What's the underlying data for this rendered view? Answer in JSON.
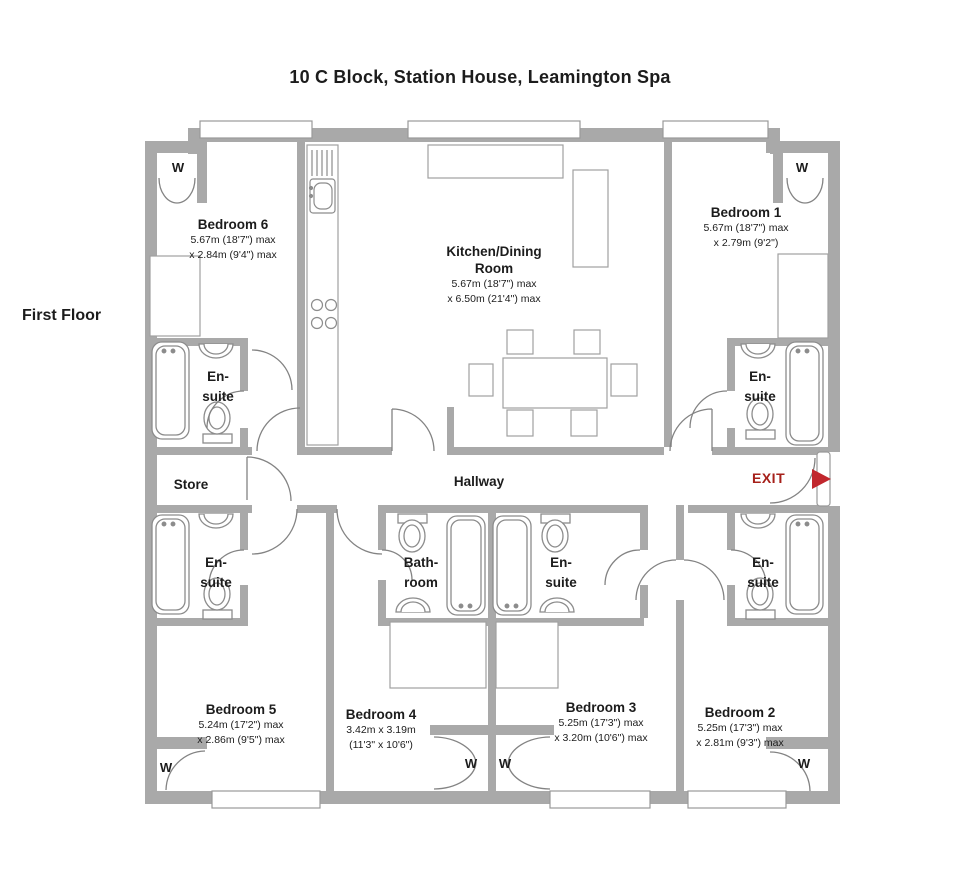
{
  "title": "10 C Block, Station House, Leamington Spa",
  "floor_label": "First Floor",
  "wardrobe_label": "W",
  "exit": {
    "label": "EXIT"
  },
  "colors": {
    "wall": "#a9a9a9",
    "exit_red": "#a6201a",
    "arrow_red": "#c1272d"
  },
  "rooms": {
    "bedroom6": {
      "name": "Bedroom 6",
      "dim1": "5.67m (18'7\") max",
      "dim2": "x 2.84m (9'4\") max"
    },
    "kitchen": {
      "name1": "Kitchen/Dining",
      "name2": "Room",
      "dim1": "5.67m (18'7\") max",
      "dim2": "x 6.50m (21'4\") max"
    },
    "bedroom1": {
      "name": "Bedroom 1",
      "dim1": "5.67m (18'7\") max",
      "dim2": "x 2.79m (9'2\")"
    },
    "ensuite": {
      "name1": "En-",
      "name2": "suite"
    },
    "store": {
      "name": "Store"
    },
    "hallway": {
      "name": "Hallway"
    },
    "bathroom": {
      "name1": "Bath-",
      "name2": "room"
    },
    "bedroom5": {
      "name": "Bedroom 5",
      "dim1": "5.24m (17'2\") max",
      "dim2": "x 2.86m (9'5\") max"
    },
    "bedroom4": {
      "name": "Bedroom 4",
      "dim1": "3.42m x 3.19m",
      "dim2": "(11'3\" x 10'6\")"
    },
    "bedroom3": {
      "name": "Bedroom 3",
      "dim1": "5.25m (17'3\") max",
      "dim2": "x 3.20m (10'6\") max"
    },
    "bedroom2": {
      "name": "Bedroom 2",
      "dim1": "5.25m (17'3\") max",
      "dim2": "x 2.81m (9'3\") max"
    }
  }
}
